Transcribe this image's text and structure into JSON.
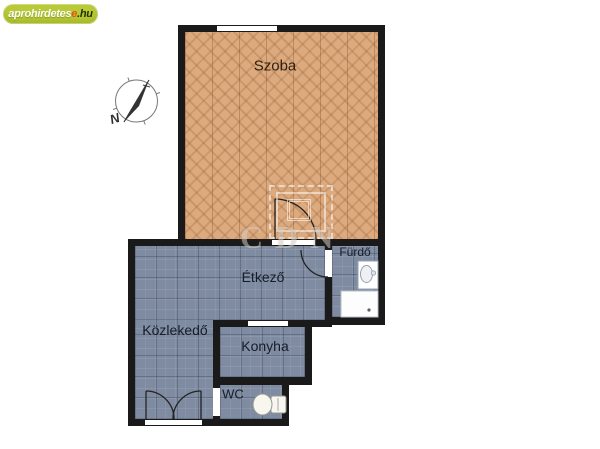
{
  "logo": {
    "part1": "aprohirdetes",
    "part2": "e",
    "part3": ".hu"
  },
  "compass": {
    "letter": "N"
  },
  "watermark": {
    "text": "CDN"
  },
  "rooms": {
    "szoba": {
      "label": "Szoba"
    },
    "furdo": {
      "label": "Fürdő"
    },
    "etkezo": {
      "label": "Étkező"
    },
    "kozlekedo": {
      "label": "Közlekedő"
    },
    "konyha": {
      "label": "Konyha"
    },
    "wc": {
      "label": "WC"
    }
  },
  "fixtures": [
    "washbasin",
    "bathtub",
    "toilet",
    "double-entrance-door",
    "interior-door",
    "window"
  ],
  "colors": {
    "wall": "#1a1a1a",
    "wood_floor": "#dcaa7d",
    "tile_floor": "#7e8ba1",
    "logo_bg": "#b9ca39",
    "logo_accent": "#e8530e",
    "logo_dark": "#223000"
  }
}
